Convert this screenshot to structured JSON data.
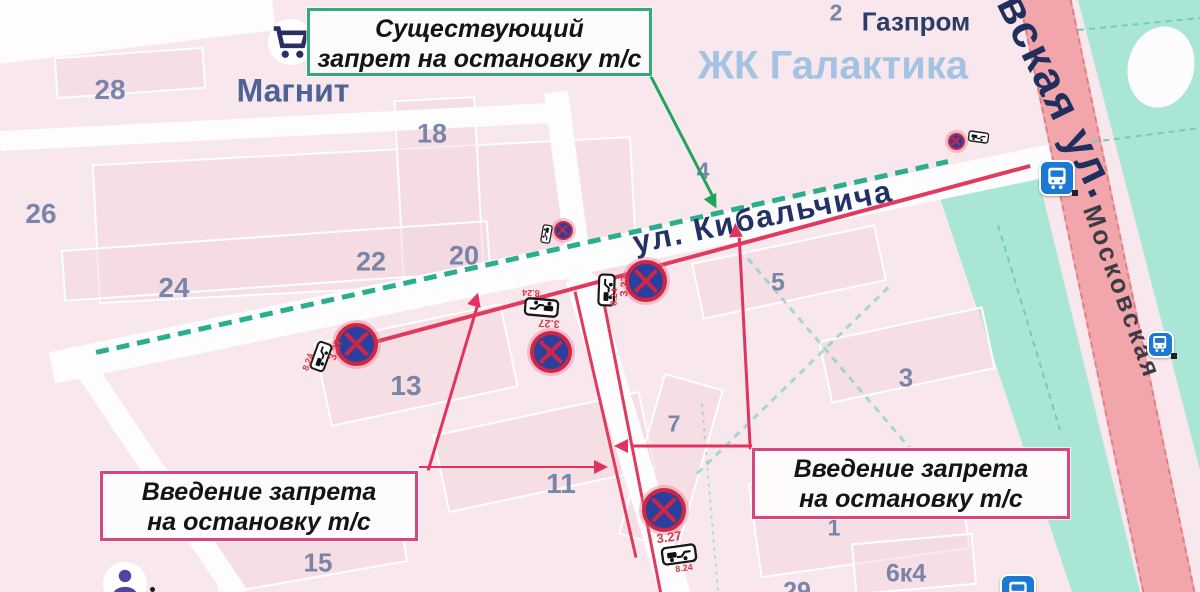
{
  "boxes": {
    "existing": {
      "line1": "Существующий",
      "line2": "запрет на остановку т/с",
      "border": "#35a97a"
    },
    "new_left": {
      "line1": "Введение запрета",
      "line2": "на остановку т/с",
      "border": "#d5487f"
    },
    "new_right": {
      "line1": "Введение запрета",
      "line2": "на остановку т/с",
      "border": "#d5487f"
    }
  },
  "sign_codes": {
    "no_stopping": "3.27",
    "tow_plate": "8.24"
  },
  "street_labels": [
    {
      "name": "street-label-kibalchicha",
      "text": "ул. Кибальчича",
      "x": 763,
      "y": 217,
      "rot": -11.5,
      "size": 31,
      "color": "#233266",
      "weight": 700,
      "spacing": 2
    },
    {
      "name": "street-label-moskovskaya",
      "text": "Московская",
      "x": 1122,
      "y": 292,
      "rot": 70,
      "size": 26,
      "color": "#3c3c46",
      "weight": 600,
      "spacing": 3
    },
    {
      "name": "street-label-moskovskaya-ul",
      "text": "вская ул.",
      "x": 1058,
      "y": 96,
      "rot": 64,
      "size": 45,
      "color": "#202f5c",
      "weight": 700,
      "spacing": 2
    }
  ],
  "poi_labels": [
    {
      "name": "poi-label-magnit",
      "text": "Магнит",
      "x": 293,
      "y": 91,
      "size": 32,
      "color": "#4d6296",
      "weight": 700
    },
    {
      "name": "poi-label-gazprom",
      "text": "Газпром",
      "x": 916,
      "y": 22,
      "size": 26,
      "color": "#2b3d66",
      "weight": 700
    },
    {
      "name": "poi-label-zhk-galaktika",
      "text": "ЖК Галактика",
      "x": 833,
      "y": 66,
      "size": 40,
      "color": "#a4c3e3",
      "weight": 700
    }
  ],
  "building_numbers": [
    {
      "t": "28",
      "x": 110,
      "y": 90,
      "s": 28
    },
    {
      "t": "26",
      "x": 41,
      "y": 214,
      "s": 28
    },
    {
      "t": "24",
      "x": 174,
      "y": 288,
      "s": 28
    },
    {
      "t": "22",
      "x": 371,
      "y": 262,
      "s": 27
    },
    {
      "t": "20",
      "x": 464,
      "y": 256,
      "s": 27
    },
    {
      "t": "18",
      "x": 432,
      "y": 134,
      "s": 27
    },
    {
      "t": "13",
      "x": 406,
      "y": 386,
      "s": 28
    },
    {
      "t": "11",
      "x": 561,
      "y": 484,
      "s": 28
    },
    {
      "t": "15",
      "x": 318,
      "y": 563,
      "s": 26
    },
    {
      "t": "4",
      "x": 703,
      "y": 171,
      "s": 23
    },
    {
      "t": "5",
      "x": 778,
      "y": 283,
      "s": 25
    },
    {
      "t": "3",
      "x": 906,
      "y": 378,
      "s": 26
    },
    {
      "t": "7",
      "x": 674,
      "y": 424,
      "s": 23
    },
    {
      "t": "1",
      "x": 834,
      "y": 528,
      "s": 23
    },
    {
      "t": "2",
      "x": 836,
      "y": 13,
      "s": 23
    },
    {
      "t": "6к4",
      "x": 906,
      "y": 574,
      "s": 25
    },
    {
      "t": "29",
      "x": 797,
      "y": 592,
      "s": 25
    }
  ],
  "signs": [
    {
      "cx": 563,
      "cy": 230,
      "d": 19,
      "plate": {
        "cx": 546,
        "cy": 234,
        "w": 19,
        "h": 12,
        "rot": 100
      }
    },
    {
      "cx": 956,
      "cy": 141,
      "d": 17,
      "plate": {
        "cx": 978,
        "cy": 137,
        "w": 21,
        "h": 12,
        "rot": 8
      }
    },
    {
      "cx": 356,
      "cy": 344,
      "d": 43,
      "plate": {
        "cx": 321,
        "cy": 356,
        "w": 30,
        "h": 17,
        "rot": -70
      },
      "t327": {
        "x": 336,
        "y": 350,
        "rot": -70,
        "s": 11
      },
      "t824": {
        "x": 308,
        "y": 362,
        "rot": -70,
        "s": 9
      }
    },
    {
      "cx": 551,
      "cy": 352,
      "d": 42,
      "plate": {
        "cx": 541,
        "cy": 307,
        "w": 35,
        "h": 19,
        "rot": 185
      },
      "t327": {
        "x": 549,
        "y": 323,
        "rot": 183,
        "s": 11
      },
      "t824": {
        "x": 531,
        "y": 293,
        "rot": 183,
        "s": 9
      }
    },
    {
      "cx": 646,
      "cy": 281,
      "d": 42,
      "plate": {
        "cx": 606,
        "cy": 290,
        "w": 33,
        "h": 18,
        "rot": -88
      },
      "t327": {
        "x": 625,
        "y": 286,
        "rot": -87,
        "s": 11
      },
      "t824": {
        "x": 614,
        "y": 297,
        "rot": -87,
        "s": 9
      }
    },
    {
      "cx": 664,
      "cy": 510,
      "d": 44,
      "plate": {
        "cx": 679,
        "cy": 554,
        "w": 36,
        "h": 19,
        "rot": -8
      },
      "t327": {
        "x": 669,
        "y": 537,
        "rot": -8,
        "s": 13
      },
      "t824": {
        "x": 684,
        "y": 568,
        "rot": -8,
        "s": 9
      }
    }
  ],
  "bus_stops": [
    {
      "cx": 1057,
      "cy": 178,
      "s": 36
    },
    {
      "cx": 1160,
      "cy": 344,
      "s": 27
    },
    {
      "cx": 1018,
      "cy": 592,
      "s": 36
    }
  ],
  "other_icons": {
    "cart": {
      "cx": 291,
      "cy": 42,
      "r": 23
    },
    "person": {
      "cx": 125,
      "cy": 584,
      "r": 22,
      "dot": {
        "x": 150,
        "y": 587
      }
    }
  },
  "lines": {
    "red_ban": [
      {
        "name": "red-ban-line-kibalchicha",
        "p": [
          356,
          347,
          1030,
          166
        ],
        "w": 4
      },
      {
        "name": "red-ban-line-side-street-west",
        "p": [
          575,
          291,
          636,
          557
        ],
        "w": 3
      },
      {
        "name": "red-ban-line-side-street-east",
        "p": [
          601,
          287,
          661,
          594
        ],
        "w": 3
      }
    ],
    "green_existing": [
      {
        "name": "existing-ban-dashed-line",
        "p": [
          96,
          352,
          948,
          161
        ],
        "w": 4.5,
        "dash": 13,
        "gap": 8
      }
    ],
    "leaders": [
      {
        "name": "leader-arrow-existing",
        "p": [
          649,
          72,
          713,
          196
        ],
        "c": "#22a35a",
        "w": 2.5
      },
      {
        "name": "leader-arrow-left-diagonal",
        "p": [
          428,
          470,
          477,
          306
        ],
        "c": "#e0335f",
        "w": 2.5
      },
      {
        "name": "leader-arrow-left-horizontal",
        "p": [
          419,
          467,
          597,
          467
        ],
        "c": "#e0335f",
        "w": 2.5
      },
      {
        "name": "leader-arrow-right-horizontal",
        "p": [
          752,
          446,
          631,
          446
        ],
        "c": "#e0335f",
        "w": 2.5
      },
      {
        "name": "leader-arrow-right-vertical",
        "p": [
          750,
          449,
          739,
          237
        ],
        "c": "#e0335f",
        "w": 2.5
      }
    ],
    "paths": [
      {
        "name": "courtyard-path",
        "p": [
          697,
          473,
          888,
          287
        ],
        "c": "rgba(100,200,185,0.55)",
        "w": 2.5,
        "dash": 7,
        "gap": 6
      },
      {
        "name": "courtyard-path",
        "p": [
          748,
          258,
          952,
          497
        ],
        "c": "rgba(100,200,185,0.55)",
        "w": 2.5,
        "dash": 7,
        "gap": 6
      },
      {
        "name": "courtyard-path",
        "p": [
          702,
          404,
          718,
          592
        ],
        "c": "rgba(100,200,185,0.5)",
        "w": 2,
        "dash": 3,
        "gap": 5
      },
      {
        "name": "park-grid-path",
        "p": [
          1078,
          30,
          1200,
          18
        ],
        "c": "#72cdb8",
        "w": 2,
        "dash": 6,
        "gap": 5
      },
      {
        "name": "park-grid-path",
        "p": [
          1092,
          142,
          1200,
          128
        ],
        "c": "#72cdb8",
        "w": 2,
        "dash": 6,
        "gap": 5
      },
      {
        "name": "park-grid-path",
        "p": [
          998,
          225,
          1060,
          430
        ],
        "c": "#72cdb8",
        "w": 2,
        "dash": 6,
        "gap": 5
      }
    ]
  },
  "streets": [
    {
      "name": "street-kibalchicha",
      "p": [
        52,
        368,
        1052,
        160
      ],
      "w": 32
    },
    {
      "name": "street-north-south-upper",
      "p": [
        556,
        92,
        581,
        279
      ],
      "w": 24
    },
    {
      "name": "street-north-south-lower",
      "p": [
        580,
        278,
        676,
        596
      ],
      "w": 30
    },
    {
      "name": "street-top-horizontal",
      "p": [
        0,
        141,
        550,
        113
      ],
      "w": 20
    },
    {
      "name": "street-bottom-left-diagonal",
      "p": [
        84,
        366,
        238,
        596
      ],
      "w": 22
    }
  ],
  "road": {
    "name": "road-moskovskaya",
    "p": [
      1042,
      -15,
      1172,
      607
    ],
    "w": 52,
    "fill": "#f2a6ab",
    "edge": "#dd8087"
  },
  "buildings": [
    [
      95,
      150,
      540,
      140,
      -3
    ],
    [
      55,
      52,
      150,
      42,
      -4
    ],
    [
      398,
      98,
      82,
      180,
      -3
    ],
    [
      62,
      235,
      428,
      52,
      -4
    ],
    [
      320,
      322,
      192,
      86,
      -12
    ],
    [
      438,
      412,
      212,
      80,
      -12
    ],
    [
      212,
      513,
      192,
      66,
      -10
    ],
    [
      695,
      243,
      188,
      58,
      -12
    ],
    [
      823,
      323,
      168,
      64,
      -12
    ],
    [
      640,
      378,
      62,
      168,
      16
    ],
    [
      753,
      468,
      212,
      96,
      -8
    ],
    [
      853,
      538,
      122,
      52,
      -5
    ]
  ],
  "colors": {
    "background": "#f8e7ec",
    "park": "#a9e6d6",
    "street": "#fefdfe",
    "red_line": "#e03a5d",
    "green_dash": "#2aae8d",
    "sign_ring": "#cf2743",
    "sign_fill": "#2b3f9e",
    "code_red": "#d93a45",
    "bus_blue": "#1b79d6"
  }
}
